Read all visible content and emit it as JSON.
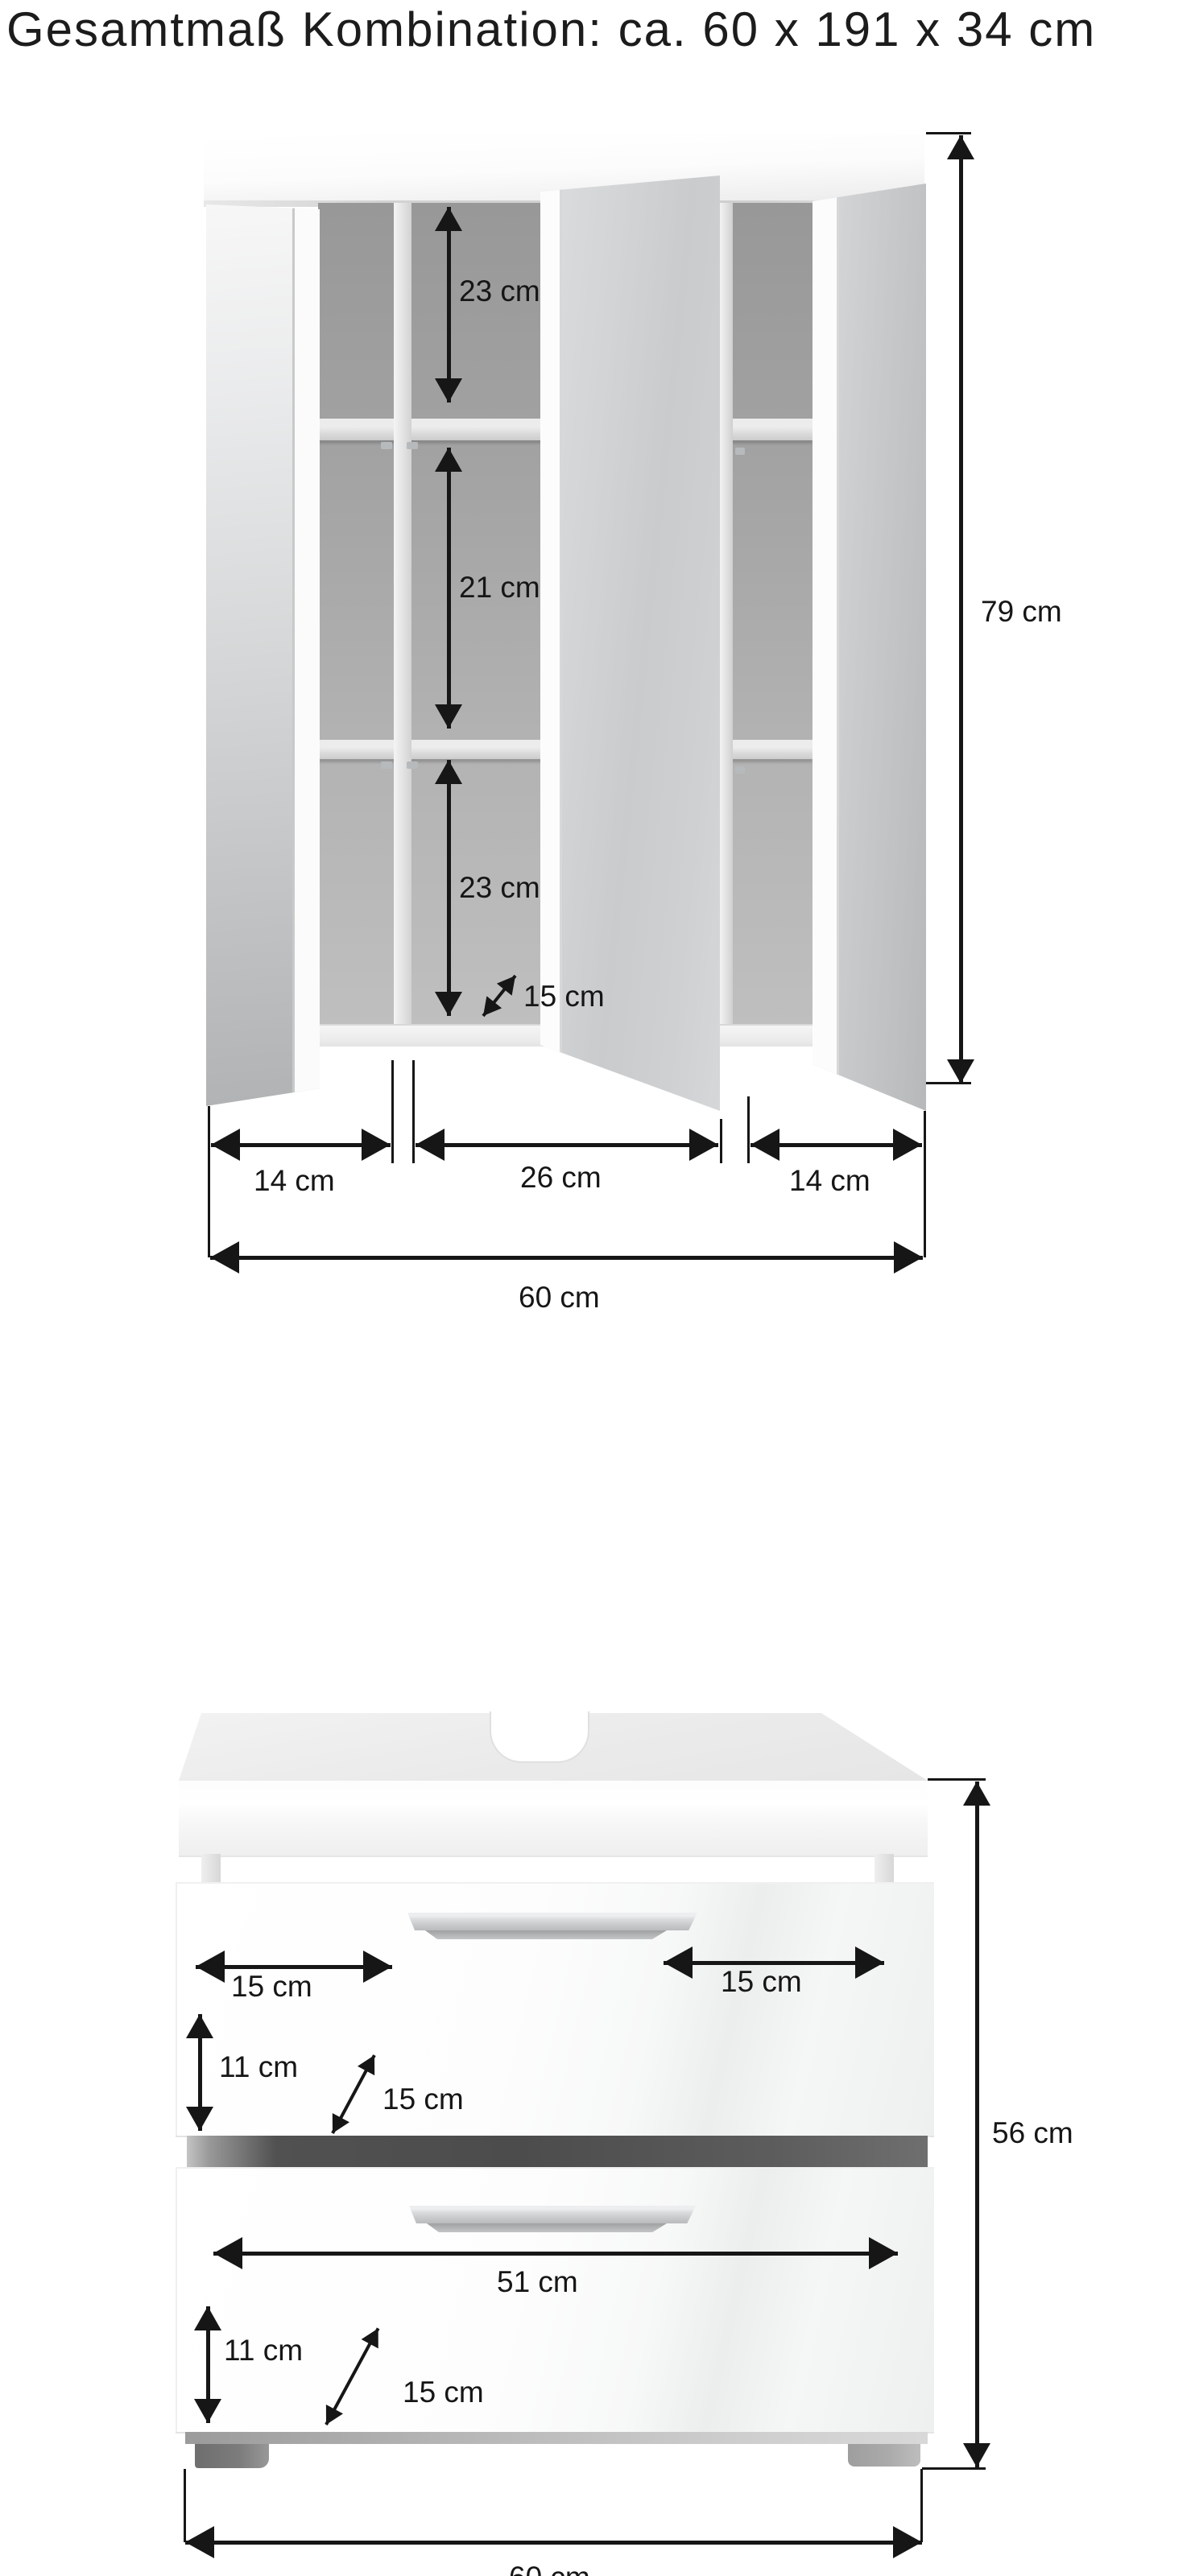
{
  "title": "Gesamtmaß Kombination: ca. 60 x 191 x 34 cm",
  "mirror_cabinet": {
    "dims": {
      "top_shelf": "23 cm",
      "middle_shelf": "21 cm",
      "bottom_shelf": "23 cm",
      "depth": "15 cm",
      "height": "79 cm",
      "left_door_width": "14 cm",
      "middle_door_width": "26 cm",
      "right_door_width": "14 cm",
      "total_width": "60 cm"
    }
  },
  "vanity_cabinet": {
    "dims": {
      "drawer1_left": "15 cm",
      "drawer1_right": "15 cm",
      "drawer1_front_height": "11 cm",
      "drawer1_depth": "15 cm",
      "drawer2_width": "51 cm",
      "drawer2_front_height": "11 cm",
      "drawer2_depth": "15 cm",
      "height": "56 cm",
      "total_width": "60 cm"
    }
  }
}
